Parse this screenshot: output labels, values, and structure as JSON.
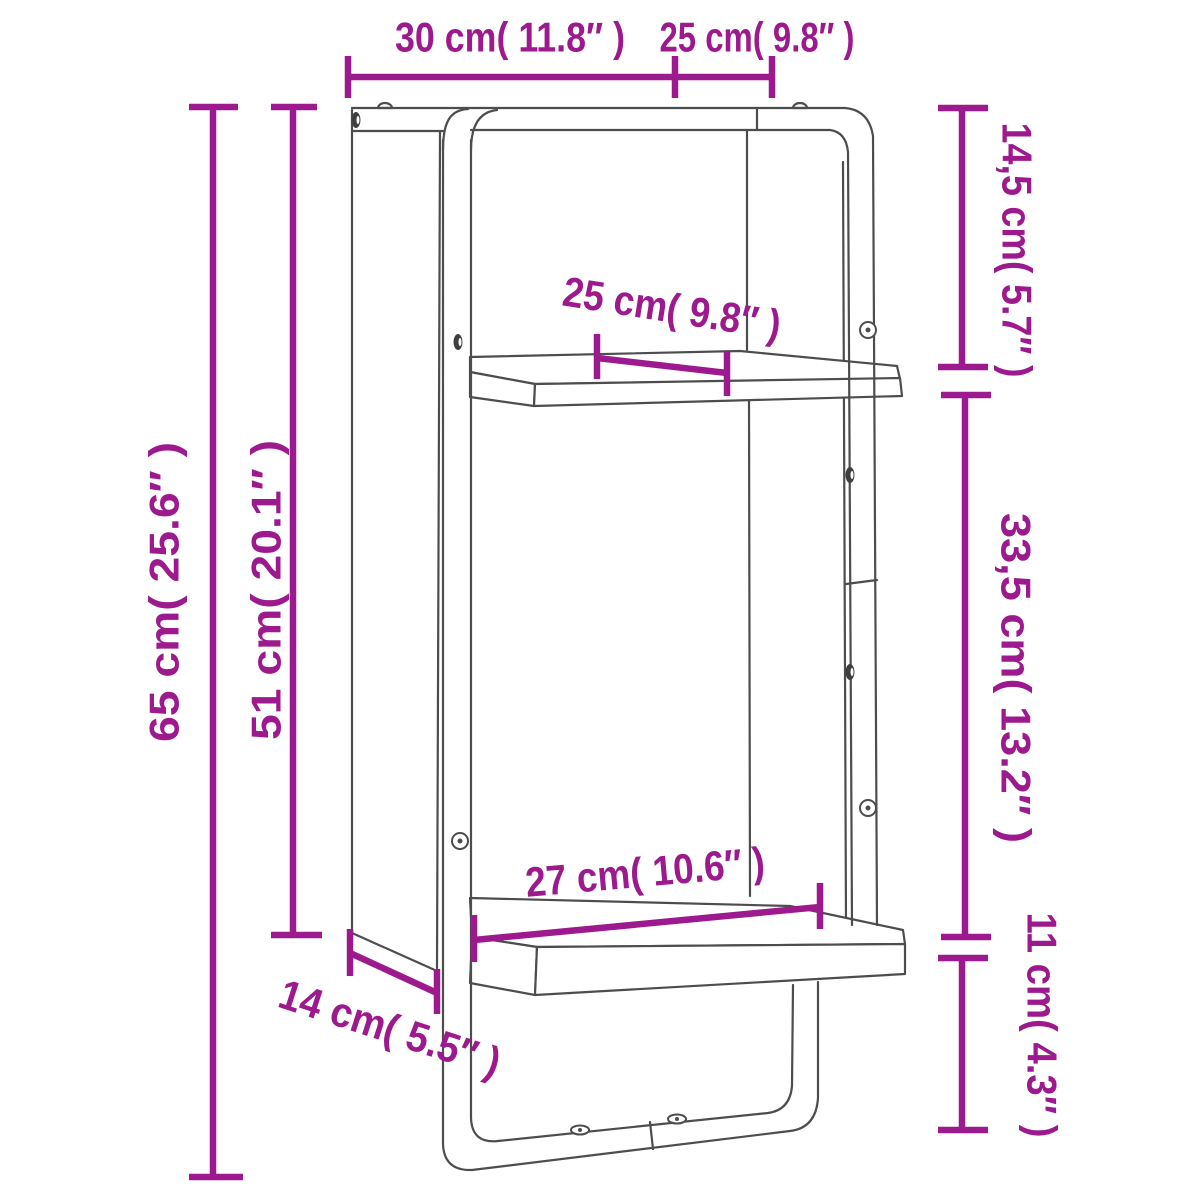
{
  "figure": {
    "kind": "product-dimension-diagram",
    "subject": "two-tier wall shelf with bar frame",
    "accent_color": "#9c1a8e",
    "line_color": "#4d4d4d",
    "background_color": "#ffffff"
  },
  "dims": {
    "top_width": "30 cm( 11.8″ )",
    "top_depth": "25 cm( 9.8″ )",
    "right_upper": "14,5 cm( 5.7″ )",
    "shelf_depth": "25 cm( 9.8″ )",
    "left_total": "65 cm( 25.6″ )",
    "left_inner": "51 cm( 20.1″ )",
    "right_mid": "33,5 cm( 13.2″ )",
    "lower_width": "27 cm( 10.6″ )",
    "bottom_depth": "14 cm( 5.5″ )",
    "right_lower": "11 cm( 4.3″ )"
  }
}
